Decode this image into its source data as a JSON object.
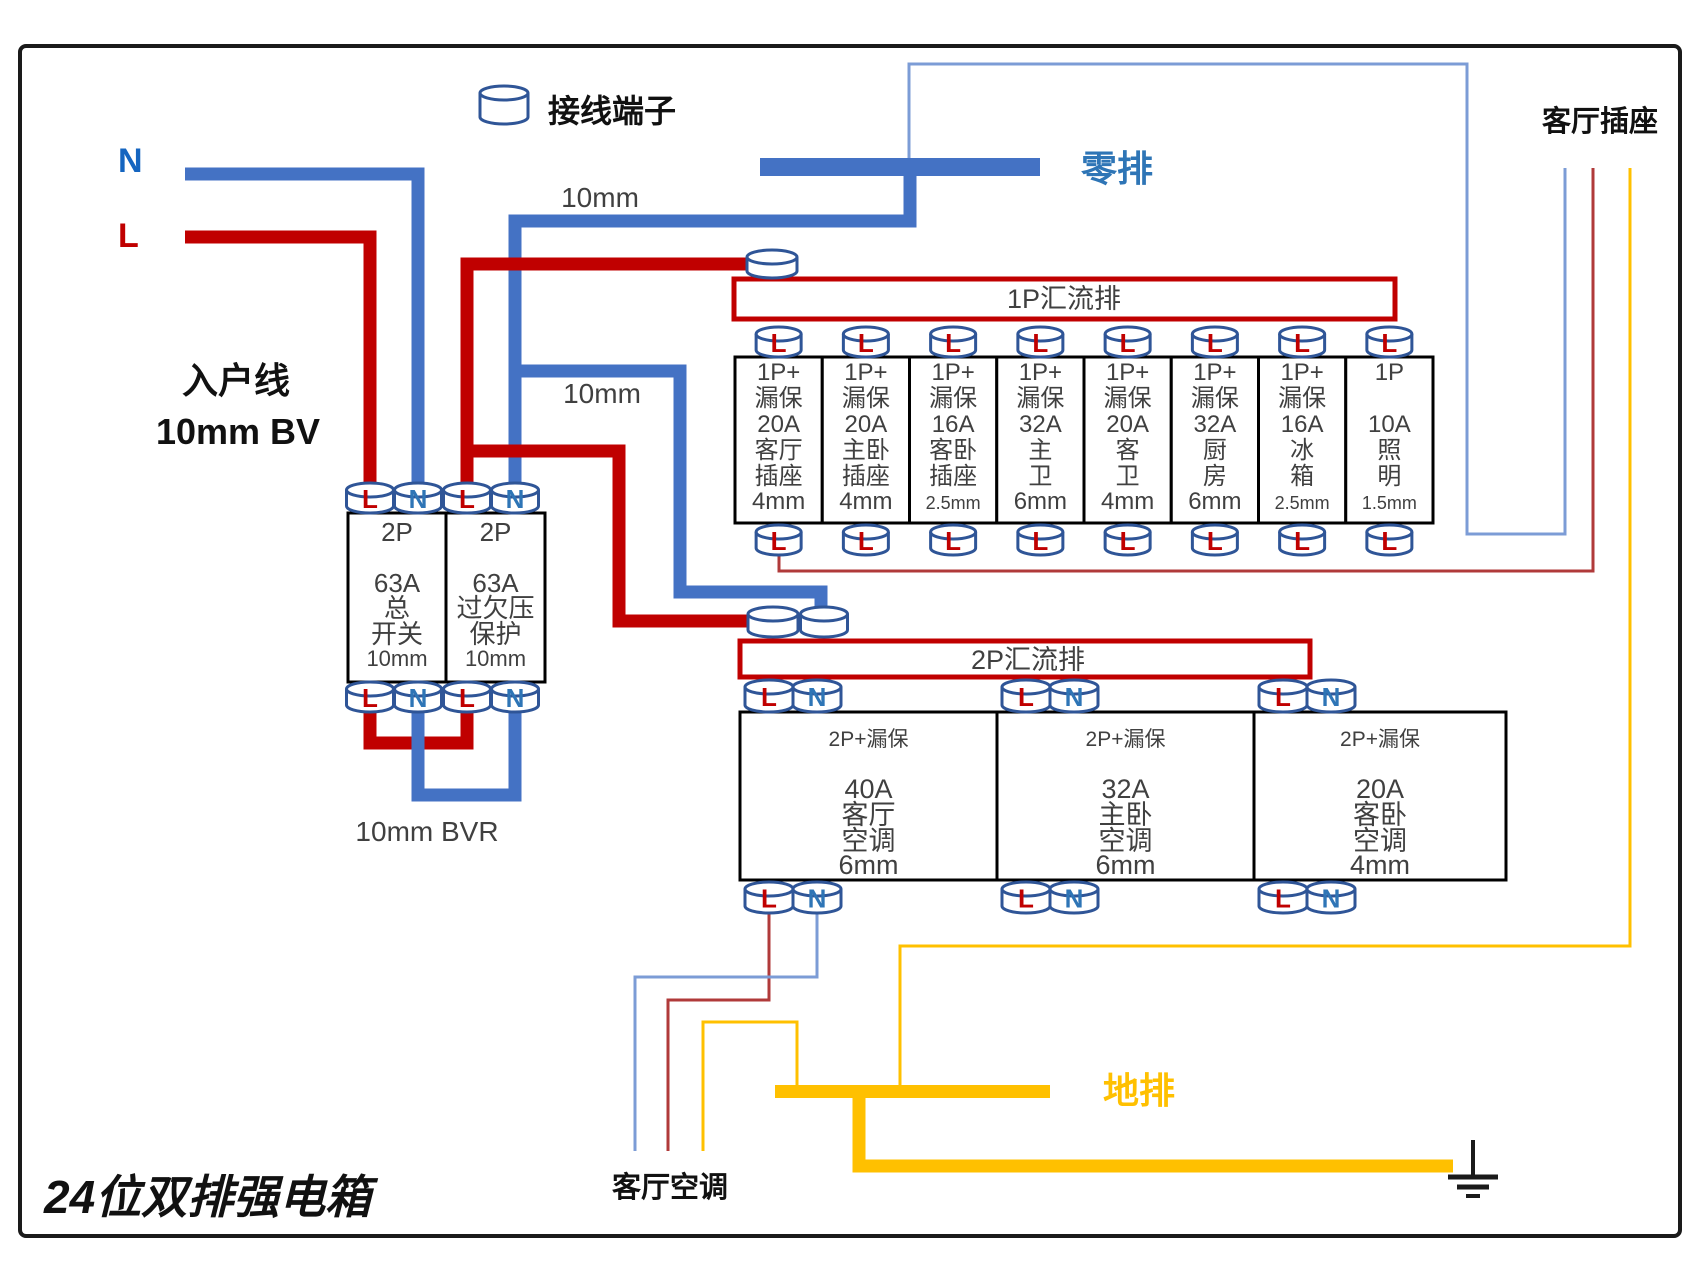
{
  "title": "24位双排强电箱",
  "legend": {
    "terminal_label": "接线端子"
  },
  "incoming": {
    "neutral_letter": "N",
    "live_letter": "L",
    "name_line1": "入户线",
    "name_line2": "10mm BV"
  },
  "wire_labels": {
    "neutral_upper": "10mm",
    "neutral_lower": "10mm",
    "bottom_loop": "10mm BVR"
  },
  "bars": {
    "neutral_bar": "零排",
    "ground_bar": "地排"
  },
  "busbars": {
    "p1": "1P汇流排",
    "p2": "2P汇流排"
  },
  "terminals": {
    "main_top": [
      "L",
      "N",
      "L",
      "N"
    ],
    "main_bottom": [
      "L",
      "N",
      "L",
      "N"
    ],
    "p1_letter": "L",
    "p2_pair": [
      "L",
      "N"
    ]
  },
  "main_breakers": [
    {
      "lines": [
        "2P",
        "",
        "63A",
        "总",
        "开关",
        "10mm"
      ]
    },
    {
      "lines": [
        "2P",
        "",
        "63A",
        "过欠压",
        "保护",
        "10mm"
      ]
    }
  ],
  "p1_breakers": [
    {
      "lines": [
        "1P+",
        "漏保",
        "20A",
        "客厅",
        "插座",
        "4mm"
      ]
    },
    {
      "lines": [
        "1P+",
        "漏保",
        "20A",
        "主卧",
        "插座",
        "4mm"
      ]
    },
    {
      "lines": [
        "1P+",
        "漏保",
        "16A",
        "客卧",
        "插座",
        "2.5mm"
      ]
    },
    {
      "lines": [
        "1P+",
        "漏保",
        "32A",
        "主",
        "卫",
        "6mm"
      ]
    },
    {
      "lines": [
        "1P+",
        "漏保",
        "20A",
        "客",
        "卫",
        "4mm"
      ]
    },
    {
      "lines": [
        "1P+",
        "漏保",
        "32A",
        "厨",
        "房",
        "6mm"
      ]
    },
    {
      "lines": [
        "1P+",
        "漏保",
        "16A",
        "冰",
        "箱",
        "2.5mm"
      ]
    },
    {
      "lines": [
        "1P",
        "",
        "10A",
        "照",
        "明",
        "1.5mm"
      ]
    }
  ],
  "p2_breakers": [
    {
      "lines": [
        "2P+漏保",
        "",
        "40A",
        "客厅",
        "空调",
        "6mm"
      ]
    },
    {
      "lines": [
        "2P+漏保",
        "",
        "32A",
        "主卧",
        "空调",
        "6mm"
      ]
    },
    {
      "lines": [
        "2P+漏保",
        "",
        "20A",
        "客卧",
        "空调",
        "4mm"
      ]
    }
  ],
  "loads": {
    "socket": "客厅插座",
    "aircon": "客厅空调"
  },
  "colors": {
    "live": "#C00000",
    "live_thin": "#B03A3A",
    "neutral": "#4472C4",
    "neutral_thin": "#7C9CD6",
    "neutral_letter": "#2E75B6",
    "incoming_n": "#1565C0",
    "ground": "#FFC000",
    "box_text": "#404040",
    "cylinder_stroke": "#2F5597",
    "ink": "#111111"
  }
}
